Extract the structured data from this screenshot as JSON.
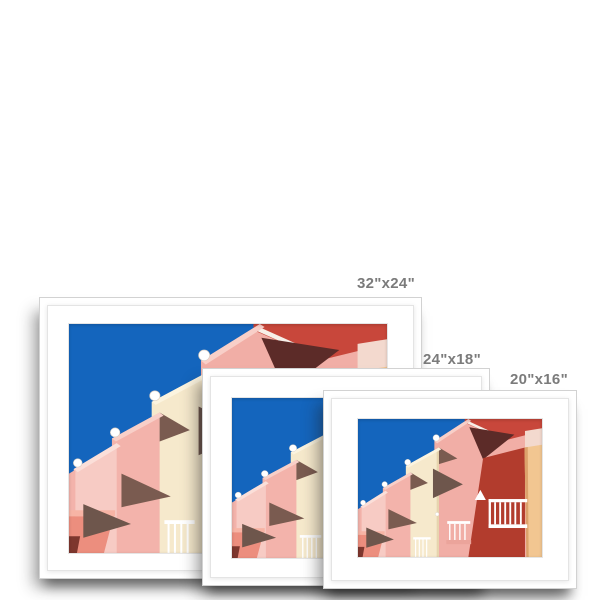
{
  "page": {
    "background": "#ffffff"
  },
  "labels": {
    "color": "#7b7b7b"
  },
  "frames": [
    {
      "label": "32\"x24\"",
      "name": "frame-32x24"
    },
    {
      "label": "24\"x18\"",
      "name": "frame-24x18"
    },
    {
      "label": "20\"x16\"",
      "name": "frame-20x16"
    }
  ],
  "photo": {
    "description": "Pastel pink and cream stepped apartment balconies with white sphere finials against a deep blue sky; dark red building with white balustrades on the right and a peach column at the far right edge",
    "frame_style": "white frame with white mat",
    "colors": {
      "sky": "#1465bd",
      "pink_a": "#f1aea6",
      "pink_rim": "#f8cfc8",
      "pink_deep": "#eba49b",
      "cream": "#f6e9cc",
      "cream_rim": "#fcf4df",
      "cream_edge": "#e6d4ae",
      "pink_c": "#f3b3ab",
      "pink_d": "#f7cbc4",
      "pink_d_rim": "#fbdfd9",
      "coral": "#ec8e7e",
      "coral_rim": "#f7b4a5",
      "dark_red": "#7e372e",
      "wedge": "#6e564c",
      "wedge_2": "#7a5b50",
      "roof_red": "#c8473b",
      "roof_fascia": "#f7efe8",
      "maroon": "#5c2b28",
      "wall_red": "#b23c2d",
      "sunlit_pink": "#f3d9ce",
      "peach": "#f2c691",
      "peach_shade": "#dca26b"
    }
  }
}
